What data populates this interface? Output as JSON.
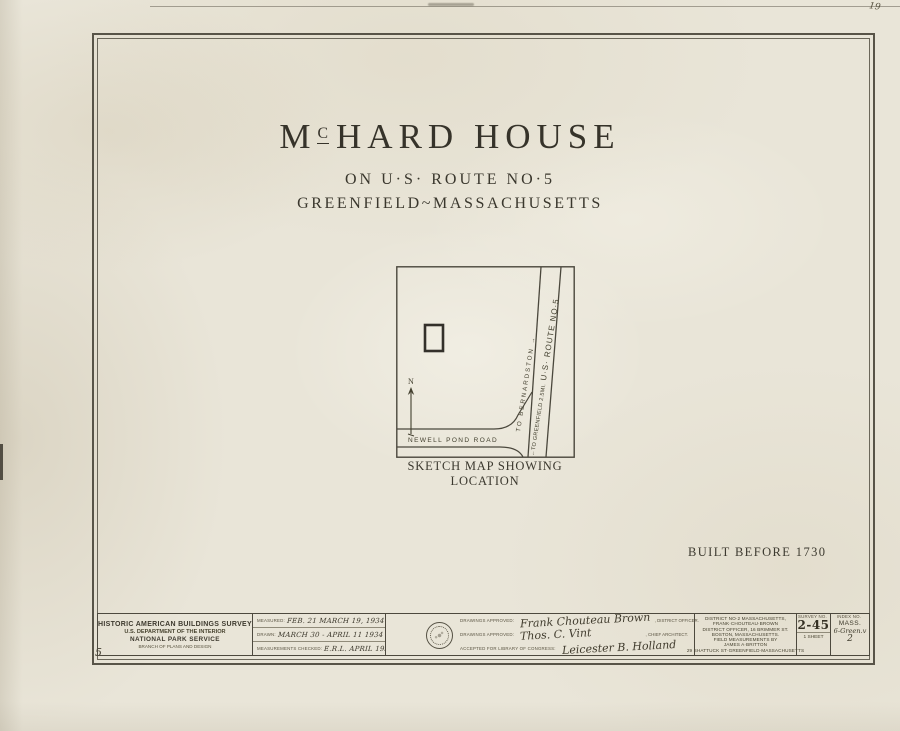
{
  "page": {
    "corner_mark": "19",
    "sheet_mark": "5"
  },
  "colors": {
    "ink": "#3f3c33",
    "paper": "#e9e5d8"
  },
  "title": {
    "part1": "M",
    "part2": "C",
    "part3": "HARD HOUSE",
    "line2": "ON U·S· ROUTE NO·5",
    "line3": "GREENFIELD~MASSACHUSETTS"
  },
  "map": {
    "caption": "SKETCH MAP SHOWING LOCATION",
    "road_label": "NEWELL POND ROAD",
    "north": "N",
    "bernardston": "TO BERNARDSTON →",
    "greenfield": "←TO GREENFIELD 2.5MI.",
    "route": " U·S· ROUTE NO·5"
  },
  "note": "BUILT BEFORE 1730",
  "titleblock": {
    "agency": {
      "line1": "HISTORIC AMERICAN BUILDINGS SURVEY",
      "line2": "U.S. DEPARTMENT OF THE INTERIOR",
      "line3": "NATIONAL PARK SERVICE",
      "line4": "BRANCH OF PLANS AND DESIGN"
    },
    "dates": [
      {
        "label": "MEASURED:",
        "value": "FEB. 21  MARCH 19, 1934"
      },
      {
        "label": "DRAWN:",
        "value": "MARCH 30 - APRIL 11 1934"
      },
      {
        "label": "MEASUREMENTS CHECKED:",
        "value": "E.R.L. APRIL 1934"
      }
    ],
    "approvals": [
      {
        "label": "DRAWINGS APPROVED:",
        "signature": "Frank Chouteau Brown",
        "role": ", DISTRICT OFFICER."
      },
      {
        "label": "DRAWINGS APPROVED:",
        "signature": "Thos. C. Vint",
        "role": ", CHIEF ARCHITECT."
      },
      {
        "label": "ACCEPTED FOR LIBRARY OF CONGRESS:",
        "signature": "Leicester B. Holland",
        "role": ""
      }
    ],
    "district": [
      "DISTRICT NO·2 MASSACHUSETTS,",
      "FRANK·CHOUTEAU·BROWN",
      "DISTRICT OFFICER, 16 BRIMMER ST.",
      "BOSTON, MASSACHUSETTS.",
      "FIELD MEASUREMENTS BY",
      "JAMES A·BRITTON",
      "29 SHATTUCK ST·GREENFIELD·MASSACHUSETTS"
    ],
    "survey": {
      "label": "SURVEY NO.",
      "number": "2-45",
      "sheets": "1 SHEET"
    },
    "index": {
      "label": "INDEX NO.",
      "state": "MASS.",
      "code": "6-Green.v",
      "number": "2"
    }
  }
}
